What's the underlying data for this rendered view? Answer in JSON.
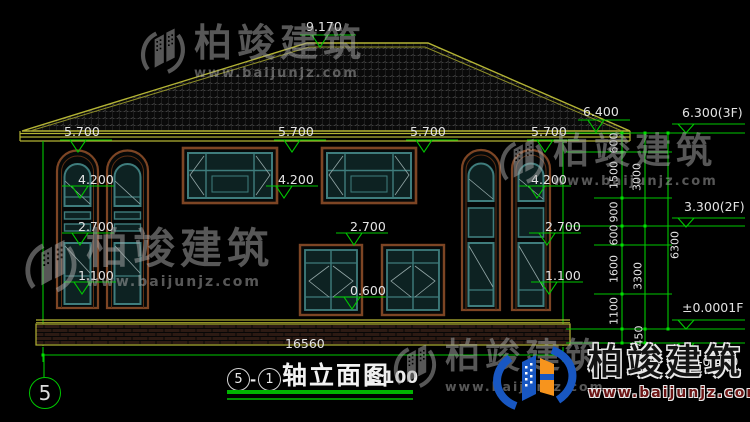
{
  "elevations": {
    "ridge": "9.170",
    "eave": [
      "5.700",
      "5.700",
      "5.700",
      "5.700"
    ],
    "eave_right": "6.400",
    "f3": "6.300(3F)",
    "f2": "3.300(2F)",
    "f1": "±0.0001F",
    "ground": "-0.450",
    "win_head_2f": [
      "4.200",
      "4.200",
      "4.200"
    ],
    "sill_2f": [
      "2.700",
      "2.700",
      "2.700"
    ],
    "win_head_1f": [
      "1.100",
      "1.100"
    ],
    "sill_1f": "0.600"
  },
  "chains": {
    "inner": [
      "600",
      "1500",
      "900",
      "600",
      "1600",
      "1100"
    ],
    "mid": [
      "3000",
      "3300",
      "450"
    ],
    "outer": [
      "6300"
    ],
    "total_width": "16560"
  },
  "axis": {
    "bubble": "5"
  },
  "title_block": {
    "axis_from": "5",
    "dash": "-",
    "axis_to": "1",
    "name": "轴立面图",
    "scale": "1:100"
  },
  "watermark": {
    "brand": "柏竣建筑",
    "url": "www.baijunjz.com"
  }
}
